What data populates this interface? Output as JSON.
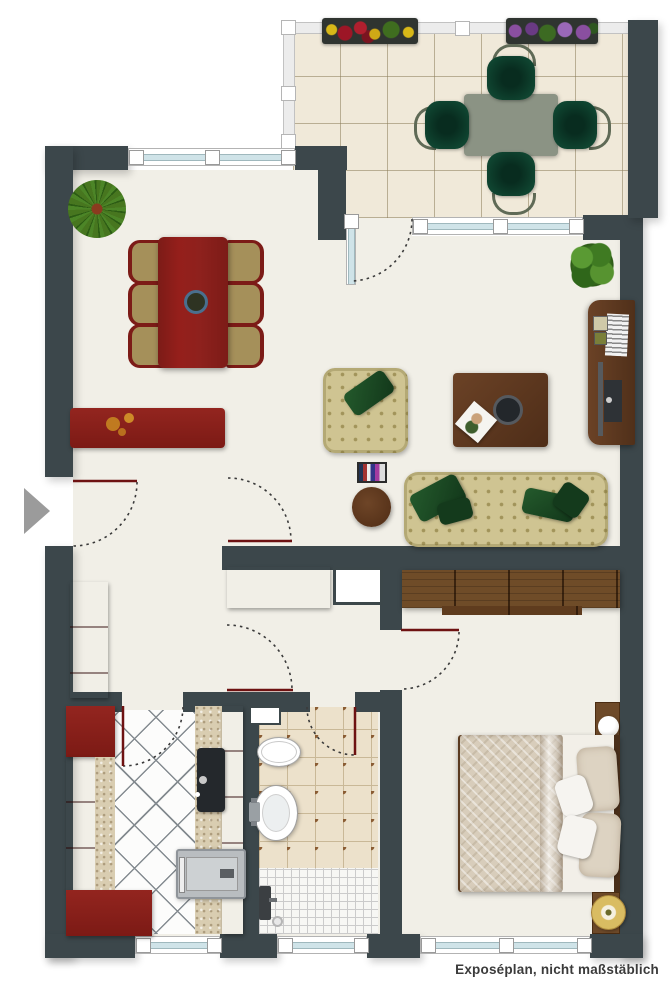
{
  "caption": {
    "text": "Exposéplan, nicht maßstäblich"
  },
  "colors": {
    "wall": "#3c474b",
    "floor": "#f1efe7",
    "fabric": "#cfc492",
    "furniture-red": "#8b211c",
    "door-leaf": "#6e1212",
    "arc": "#3a3a3a",
    "wood": "#6b4226",
    "pillow-green": "#1c4723",
    "balcony-table": "#8b9384",
    "balcony-tile": "#f0e9d9",
    "bath-tile": "#ece1cb",
    "window-glass": "#cfe3e8",
    "gold": "#c9a84c",
    "arrow-gray": "#9b9b9b"
  },
  "inventory": {
    "balcony": [
      "floor-tiles",
      "railing",
      "flower-box-red-yellow",
      "flower-box-purple",
      "outdoor-table",
      "outdoor-chairs-4"
    ],
    "living-room": [
      "potted-plant",
      "dining-table-6-chairs",
      "sideboard-with-bowls",
      "armchair",
      "coffee-table",
      "magazine-rack",
      "round-side-table",
      "sofa",
      "tv-board",
      "potted-plant"
    ],
    "hallway": [
      "wardrobe",
      "white-cabinet",
      "tall-wardrobe"
    ],
    "kitchen": [
      "cabinets",
      "countertops",
      "sink",
      "stove",
      "diamond-tile-floor"
    ],
    "bathroom": [
      "shelf",
      "toilet",
      "washbasin",
      "shower",
      "dotted-tile-floor"
    ],
    "bedroom": [
      "wardrobe",
      "double-bed",
      "nightstand-with-lamp",
      "nightstand-with-gold-lamp"
    ]
  },
  "doors": [
    "entrance",
    "balcony-door",
    "living-hall-door",
    "hall-door",
    "kitchen-door",
    "bathroom-door",
    "bedroom-door"
  ],
  "windows": [
    "living-top",
    "balcony-front",
    "kitchen",
    "bathroom",
    "bedroom"
  ]
}
